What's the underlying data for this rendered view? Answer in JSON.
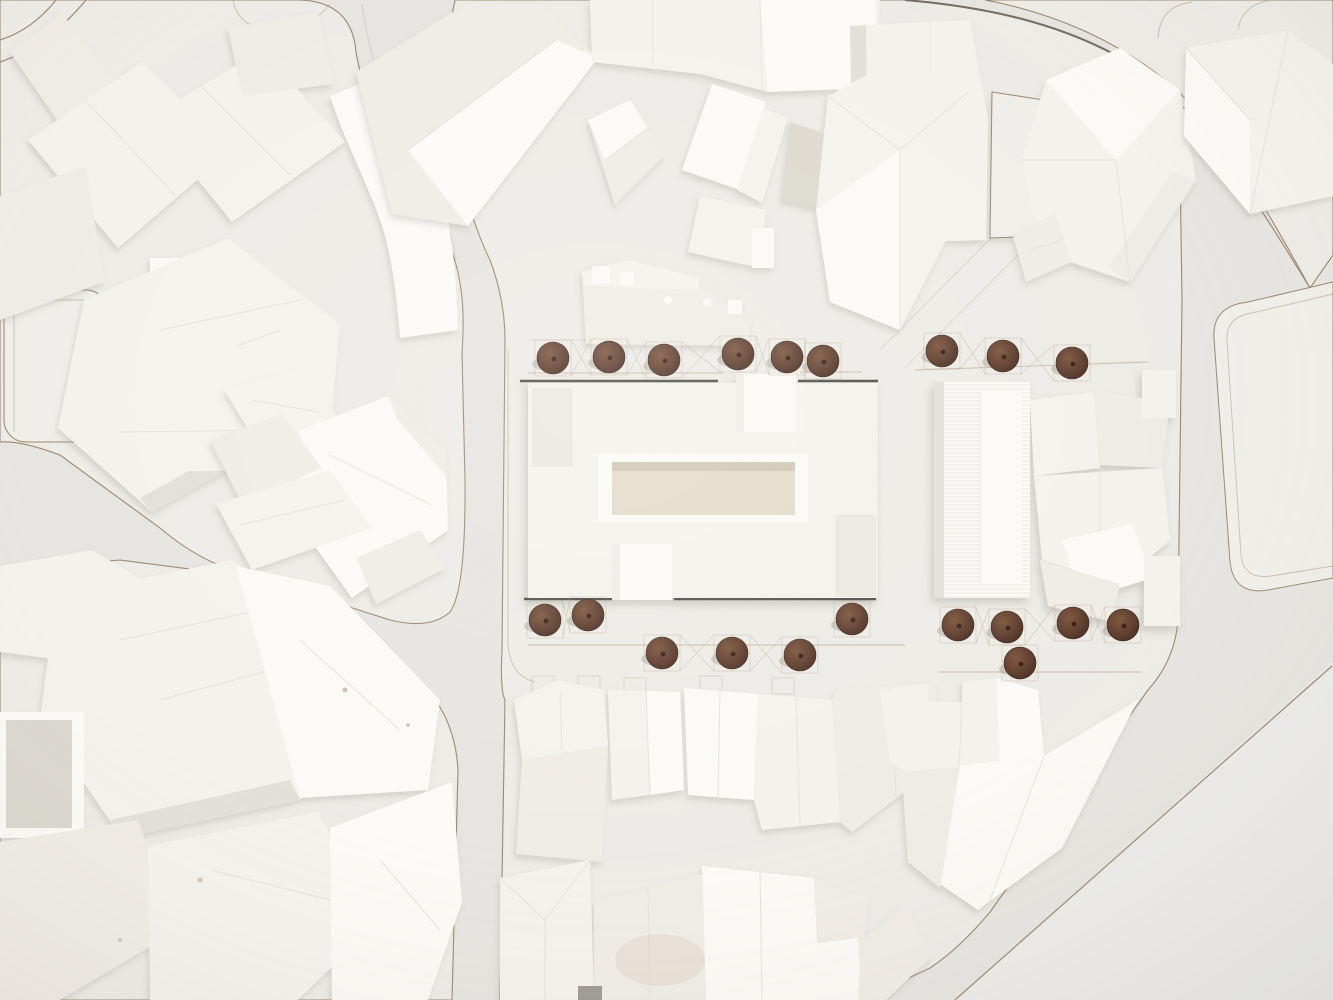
{
  "scene": {
    "description": "Top-down photograph of a white architectural massing model: a central courtyard building flanked by rows of round brown model trees, surrounded by city blocks of white gabled and flat-roofed volumes, curving laser-cut streets, an empty triangular plot on the right and a blank plaza at lower right.",
    "model_type": "physical urban massing model",
    "tree_count": 20,
    "central_building": "rectangular slab with inner courtyard, two square stair towers and two recessed terraces"
  },
  "palette": {
    "road": "#e6e4e0",
    "roadLight": "#ecebe9",
    "plate": "#edebe6",
    "plateLite": "#f0eee9",
    "bTop": "#f4f2ec",
    "bBright": "#fbfaf6",
    "bMid": "#efece4",
    "bShade": "#e2dfd6",
    "bDim": "#d9d6cc",
    "gapShade": "#dcd8cd",
    "court": "#e2dcc7",
    "courtShadow": "#c9c2ac",
    "inset": "#eae8df",
    "darkEdge": "#4b4a45",
    "curb": "#9b8265",
    "curbDark": "#6e655a",
    "pencil": "#b29878",
    "ridgeLine": "#e1ded5",
    "treeOuter": "#5d3a29",
    "treeMid": "#6e4734",
    "treeDark": "#33190f",
    "treeShadow": "#8d877c",
    "stain": "#d8c7b8"
  },
  "trees": {
    "radius": 16,
    "box": 36,
    "groups": [
      {
        "name": "north-row-west",
        "pts": [
          [
            553,
            358
          ],
          [
            609,
            357
          ],
          [
            664,
            360
          ],
          [
            738,
            354
          ],
          [
            787,
            357
          ],
          [
            823,
            361
          ]
        ]
      },
      {
        "name": "north-row-east",
        "pts": [
          [
            942,
            351
          ],
          [
            1003,
            356
          ],
          [
            1072,
            363
          ]
        ]
      },
      {
        "name": "south-row-west",
        "pts": [
          [
            545,
            620
          ],
          [
            588,
            615
          ]
        ]
      },
      {
        "name": "south-row-west-lower",
        "pts": [
          [
            662,
            653
          ],
          [
            732,
            653
          ],
          [
            800,
            655
          ]
        ]
      },
      {
        "name": "south-single",
        "pts": [
          [
            852,
            619
          ]
        ]
      },
      {
        "name": "south-row-east",
        "pts": [
          [
            958,
            625
          ],
          [
            1007,
            627
          ],
          [
            1073,
            623
          ],
          [
            1123,
            625
          ]
        ]
      },
      {
        "name": "south-row-east-lower",
        "pts": [
          [
            1020,
            663
          ]
        ]
      }
    ]
  }
}
